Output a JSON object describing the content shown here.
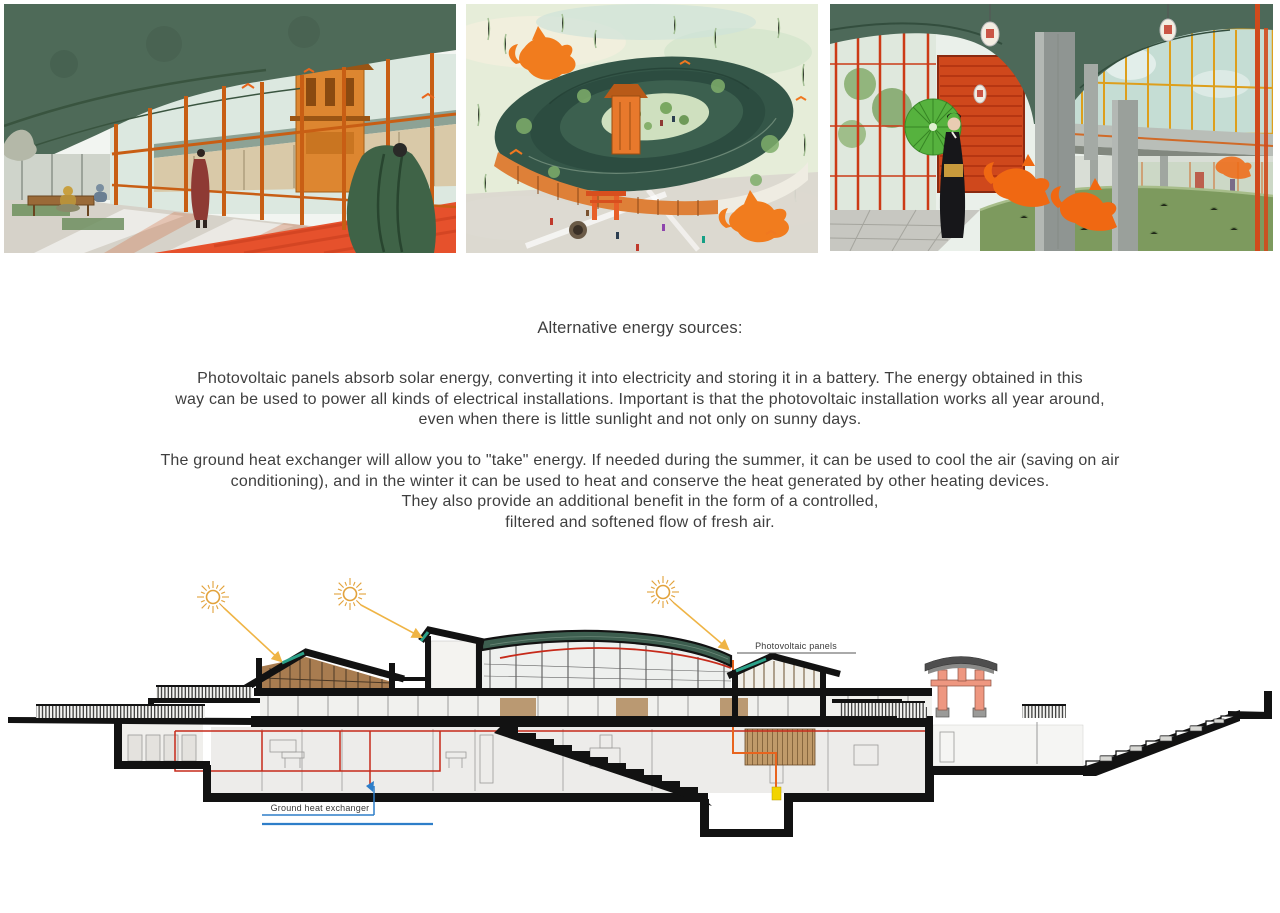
{
  "text_block": {
    "title": "Alternative energy sources:",
    "p1_lines": [
      "Photovoltaic panels absorb solar energy, converting it into electricity and storing it in a battery. The energy obtained in this",
      "way can be used to power all kinds of electrical installations. Important is that the photovoltaic installation works all year around,",
      "even when there is little sunlight and not only on sunny days."
    ],
    "p2_lines": [
      "The ground heat exchanger will allow you to \"take\" energy. If needed during the summer, it can be used to cool the air (saving on air",
      "conditioning), and in the winter it can be used  to heat and conserve the heat generated by other heating devices.",
      "They also provide an additional benefit in the form of a controlled,",
      "filtered and softened flow of fresh air."
    ]
  },
  "section_diagram": {
    "labels": {
      "photovoltaic_panels": "Photovoltaic panels",
      "ground_heat_exchanger": "Ground heat exchanger"
    },
    "colors": {
      "sun": "#E2A23B",
      "sun_arrow": "#EFB445",
      "roof_green": "#3D5E4F",
      "pv_teal": "#2BA189",
      "circuit_red": "#C62A1A",
      "circuit_orange": "#E8641E",
      "ghe_blue": "#2E7EC9",
      "torii_salmon": "#EE9780",
      "poche_black": "#121212"
    }
  }
}
